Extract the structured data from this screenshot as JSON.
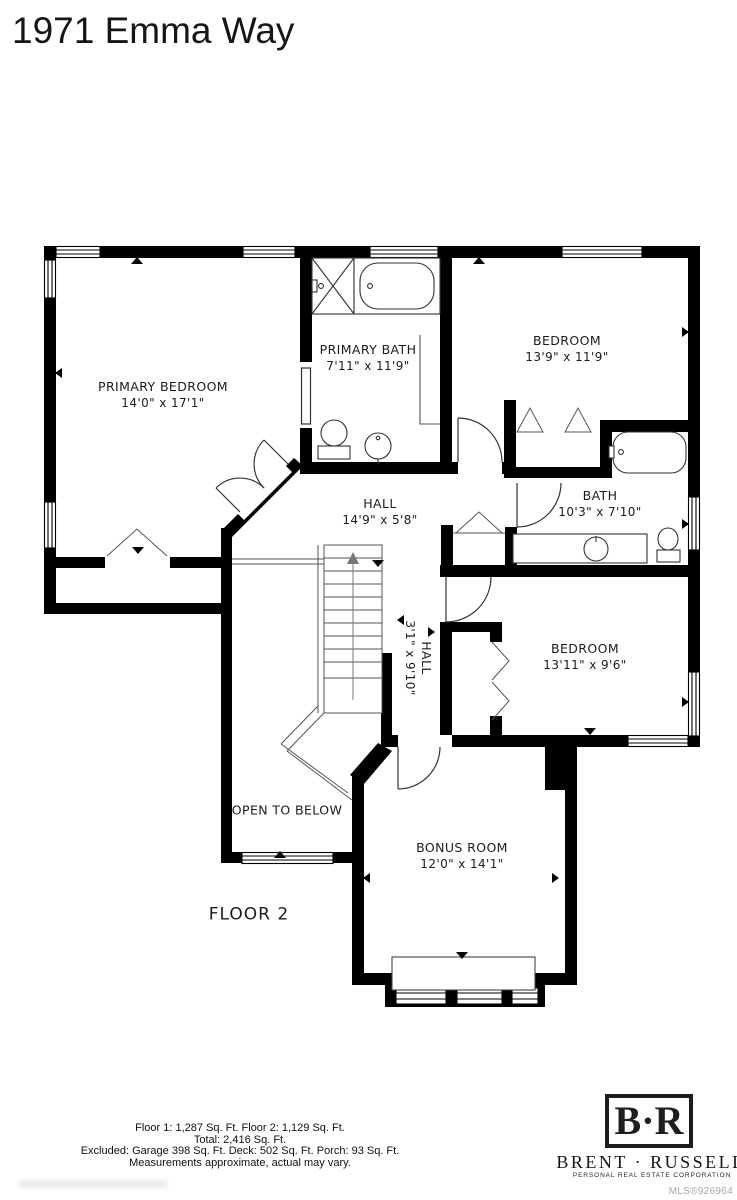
{
  "title": "1971 Emma Way",
  "plan": {
    "floor_label": "FLOOR 2",
    "open_below_label": "OPEN TO BELOW",
    "rooms": {
      "primary_bedroom": {
        "name": "PRIMARY BEDROOM",
        "dims": "14'0\" x 17'1\""
      },
      "primary_bath": {
        "name": "PRIMARY BATH",
        "dims": "7'11\" x 11'9\""
      },
      "bedroom_top": {
        "name": "BEDROOM",
        "dims": "13'9\" x 11'9\""
      },
      "hall": {
        "name": "HALL",
        "dims": "14'9\" x 5'8\""
      },
      "bath": {
        "name": "BATH",
        "dims": "10'3\" x 7'10\""
      },
      "bedroom_bottom": {
        "name": "BEDROOM",
        "dims": "13'11\" x 9'6\""
      },
      "hall_vertical": {
        "name": "HALL",
        "dims": "3'1\" x 9'10\""
      },
      "bonus_room": {
        "name": "BONUS ROOM",
        "dims": "12'0\" x 14'1\""
      }
    }
  },
  "footer": {
    "line1": "Floor 1: 1,287 Sq. Ft. Floor 2: 1,129 Sq. Ft.",
    "line2": "Total: 2,416 Sq. Ft.",
    "line3": "Excluded: Garage 398 Sq. Ft. Deck: 502 Sq. Ft. Porch: 93 Sq. Ft.",
    "line4": "Measurements approximate, actual may vary."
  },
  "branding": {
    "monogram": "B·R",
    "name": "BRENT · RUSSELL",
    "tagline": "PERSONAL REAL ESTATE CORPORATION",
    "mls": "MLS®926964"
  },
  "colors": {
    "wall": "#000000",
    "background": "#ffffff",
    "label_text": "#1c1c1c",
    "mls_gray": "#a8a8a8"
  }
}
